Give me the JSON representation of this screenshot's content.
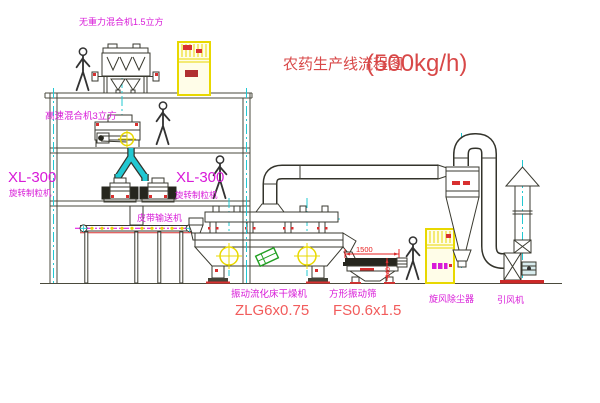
{
  "meta": {
    "type": "engineering-process-flow-diagram",
    "subject": "pesticide production line"
  },
  "title": {
    "text": "农药生产线流程图",
    "capacity": "(500kg/h)"
  },
  "colors": {
    "title_red": "#d84848",
    "label_magenta": "#d81ad8",
    "model_red": "#f25c5c",
    "dimension_red": "#e82020",
    "centerline_cyan": "#22c8d2",
    "equipment_yellow": "#e8d800",
    "structure_line": "#4a4a3c",
    "green_accent": "#22a022"
  },
  "equipment": {
    "top_mixer": {
      "label": "无重力混合机1.5立方"
    },
    "high_speed_mixer": {
      "label": "高速混合机3立方"
    },
    "granulator_left": {
      "model": "XL-300",
      "label": "旋转制粒机"
    },
    "granulator_right": {
      "model": "XL-300",
      "label": "旋转制粒机"
    },
    "belt_conveyor": {
      "label": "皮带输送机"
    },
    "fluid_bed_dryer": {
      "label": "振动流化床干燥机",
      "model": "ZLG6x0.75"
    },
    "vibrating_screen": {
      "label": "方形振动筛",
      "model": "FS0.6x1.5"
    },
    "cyclone": {
      "label": "旋风除尘器"
    },
    "fan": {
      "label": "引风机"
    }
  },
  "dimensions": {
    "screen_length": "1500",
    "screen_height": "340"
  }
}
